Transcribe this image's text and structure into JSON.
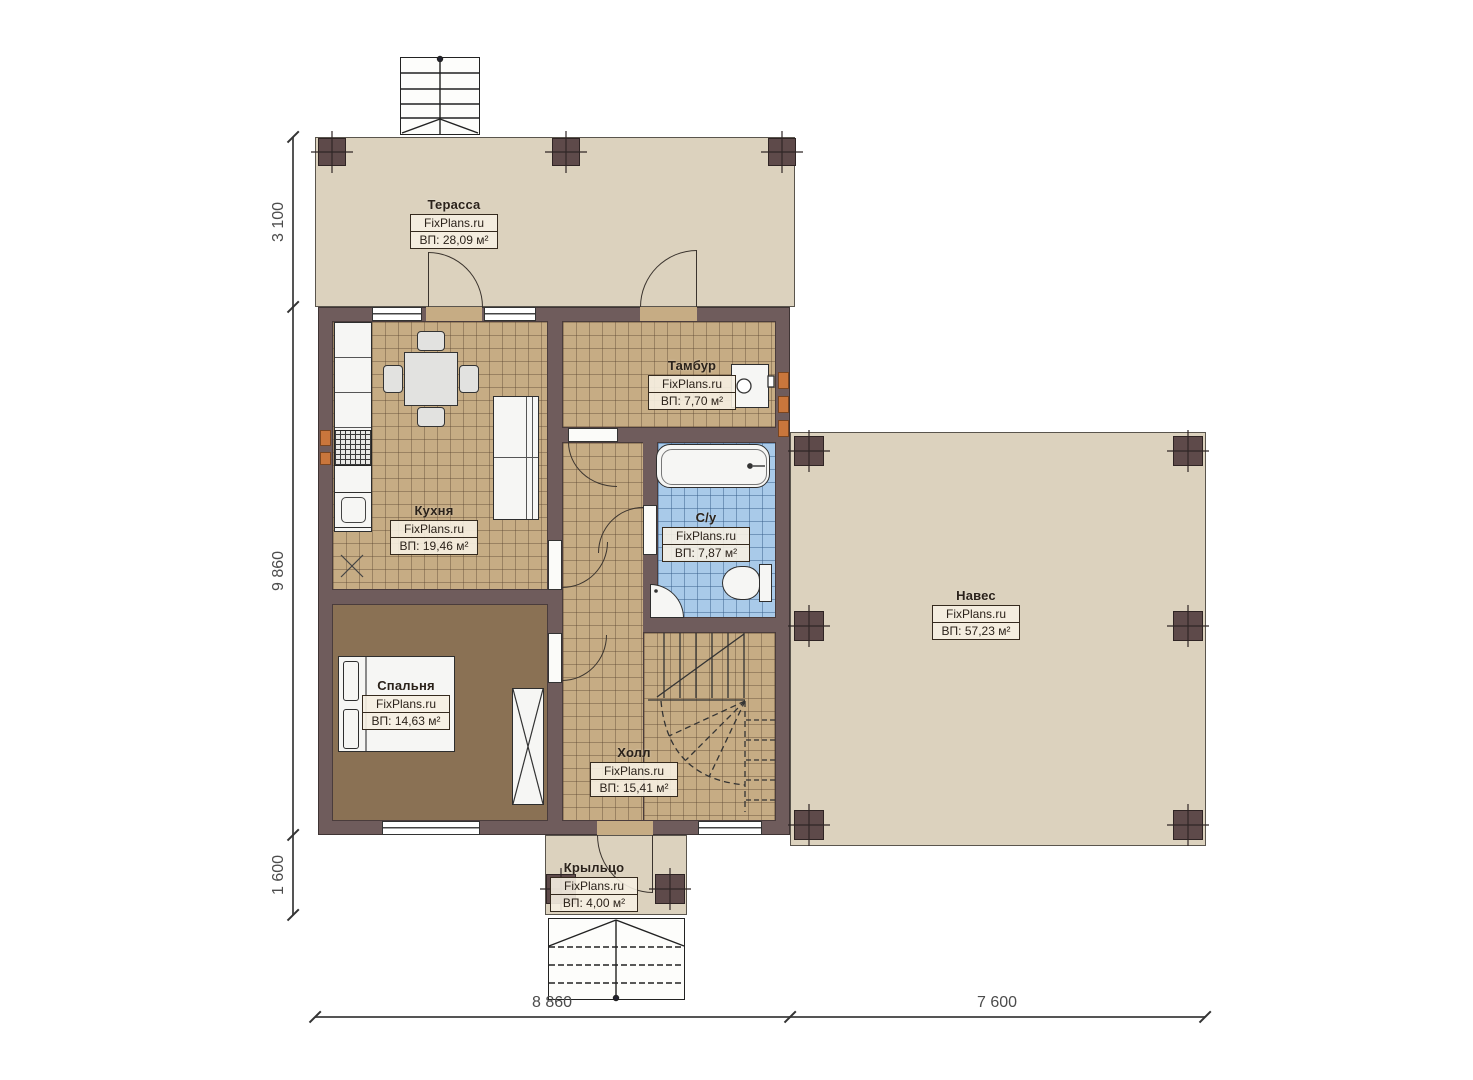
{
  "plan_title": "Floor plan — first floor",
  "brand": "FixPlans.ru",
  "rooms": {
    "terrace": {
      "name": "Терасса",
      "brand": "FixPlans.ru",
      "area": "ВП: 28,09 м²"
    },
    "vestibule": {
      "name": "Тамбур",
      "brand": "FixPlans.ru",
      "area": "ВП: 7,70 м²"
    },
    "kitchen": {
      "name": "Кухня",
      "brand": "FixPlans.ru",
      "area": "ВП: 19,46 м²"
    },
    "bathroom": {
      "name": "С/у",
      "brand": "FixPlans.ru",
      "area": "ВП: 7,87 м²"
    },
    "canopy": {
      "name": "Навес",
      "brand": "FixPlans.ru",
      "area": "ВП: 57,23 м²"
    },
    "bedroom": {
      "name": "Спальня",
      "brand": "FixPlans.ru",
      "area": "ВП: 14,63 м²"
    },
    "hall": {
      "name": "Холл",
      "brand": "FixPlans.ru",
      "area": "ВП: 15,41 м²"
    },
    "porch": {
      "name": "Крыльцо",
      "brand": "FixPlans.ru",
      "area": "ВП: 4,00 м²"
    }
  },
  "dimensions": {
    "left": [
      "3 100",
      "9 860",
      "1 600"
    ],
    "bottom": [
      "8 860",
      "7 600"
    ]
  },
  "colors": {
    "wall": "#6f5c5c",
    "open_area_floor": "#dcd2be",
    "tile_floor": "#c6ac84",
    "bathroom_floor": "#a9cae9",
    "bedroom_floor": "#8a7154",
    "radiator": "#c9763c"
  }
}
